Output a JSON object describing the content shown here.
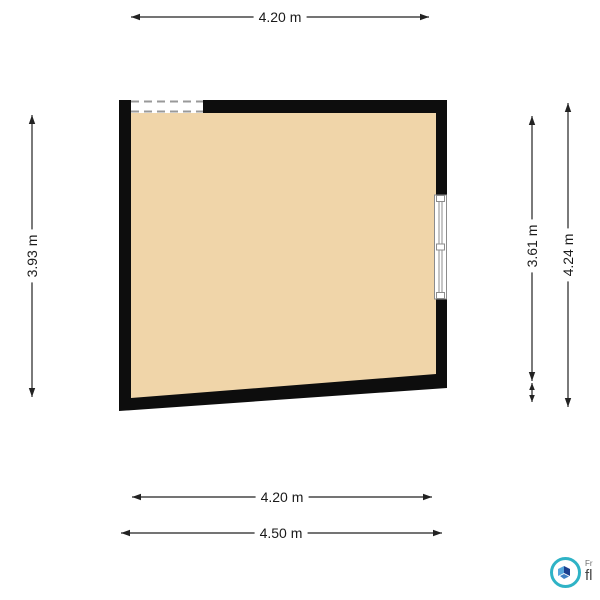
{
  "floorplan": {
    "room_name": "room",
    "colors": {
      "wall": "#0d0d0d",
      "floor": "#f0d5a9",
      "dimension_line": "#222222",
      "window_frame": "#8c8c8c",
      "opening_dash": "#999999"
    },
    "dimensions": {
      "top_width": {
        "label": "4.20 m"
      },
      "left_height": {
        "label": "3.93 m"
      },
      "right_inner_height": {
        "label": "3.61 m"
      },
      "right_outer_height": {
        "label": "4.24 m"
      },
      "bottom_inner_width": {
        "label": "4.20 m"
      },
      "bottom_outer_width": {
        "label": "4.50 m"
      }
    },
    "features": {
      "top_opening": "dashed window opening (top-left wall)",
      "right_window": "window with frame (right wall)"
    }
  },
  "watermark": {
    "brand_small_fragment": "Fr",
    "brand_large_fragment": "fl",
    "ring_color": "#2fb3c6",
    "map_dark_blue": "#1c3f8f",
    "map_light_blue": "#56a6dc"
  }
}
